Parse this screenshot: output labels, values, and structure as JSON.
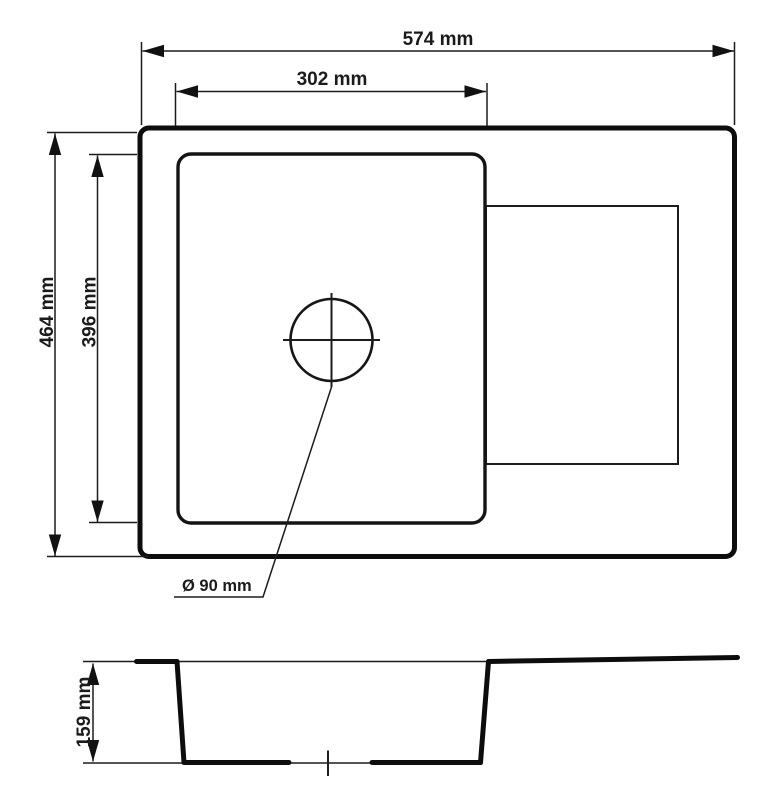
{
  "diagram": {
    "type": "sink-technical-drawing",
    "colors": {
      "background": "#ffffff",
      "line": "#111111",
      "text": "#1b1b1b"
    },
    "labels": {
      "outer_width": "574 mm",
      "bowl_width": "302 mm",
      "outer_depth": "464 mm",
      "bowl_depth": "396 mm",
      "drain_diameter": "Ø 90 mm",
      "bowl_height": "159 mm"
    },
    "dimensions_mm": {
      "outer_width": 574,
      "bowl_width": 302,
      "outer_depth": 464,
      "bowl_depth": 396,
      "drain_diameter": 90,
      "bowl_height": 159
    }
  }
}
